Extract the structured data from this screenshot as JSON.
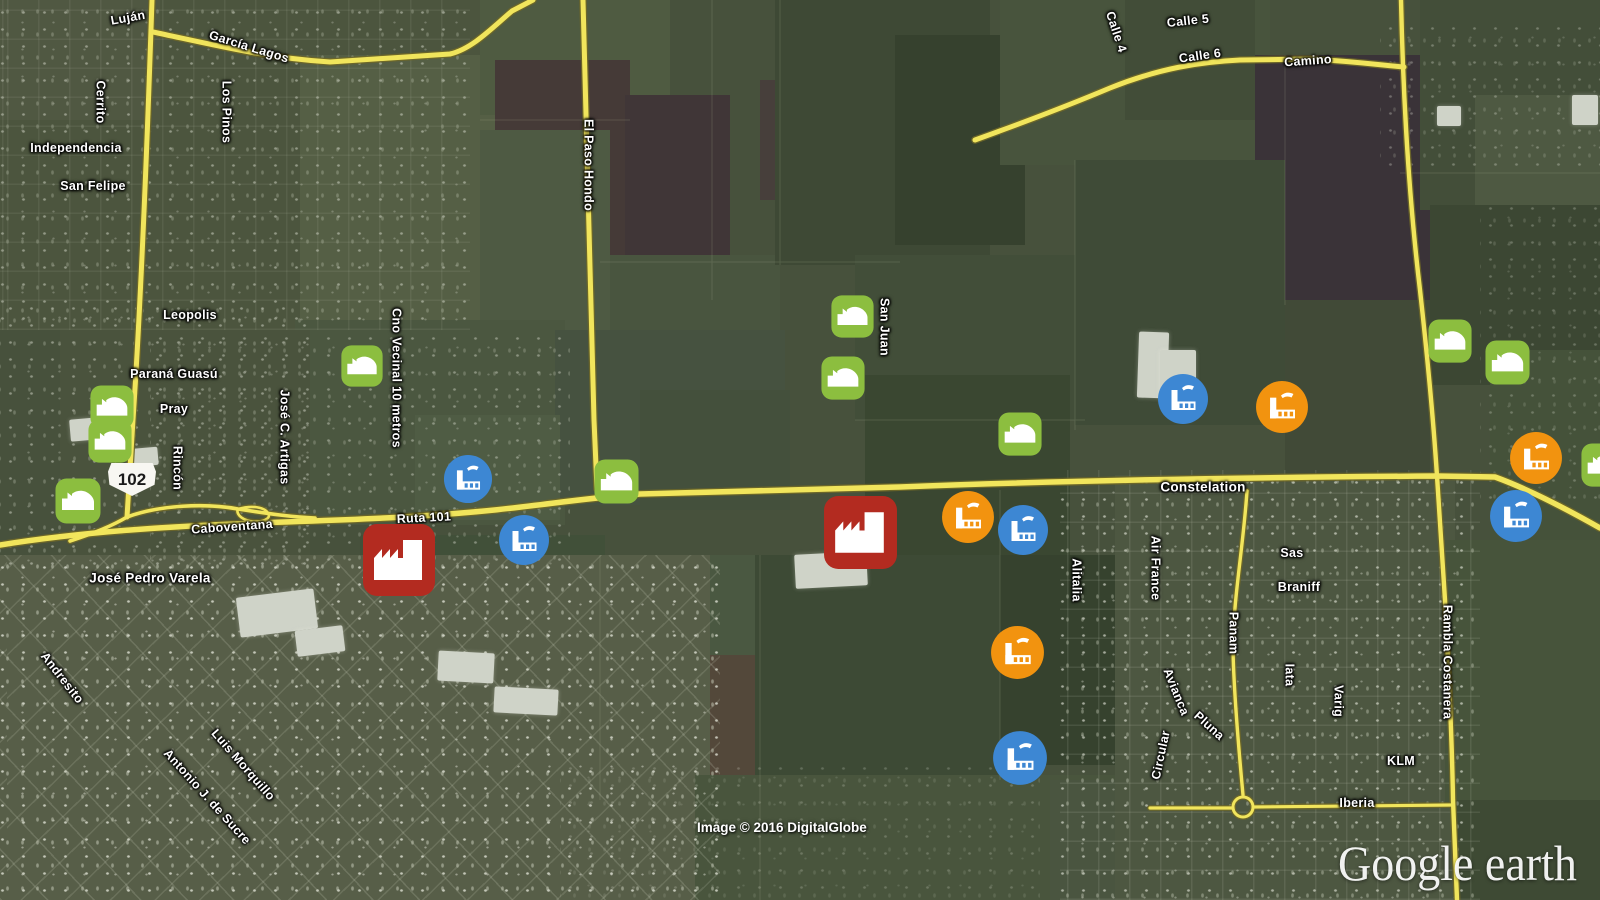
{
  "map": {
    "attribution": "Image © 2016 DigitalGlobe",
    "watermark": "Google earth",
    "route_shield": "102",
    "colors": {
      "road_fill": "#F1E55C",
      "road_casing": "#6E6728",
      "label_text": "#FFFFFF",
      "marker_green": "#8CBE3F",
      "marker_blue": "#3D87D3",
      "marker_orange": "#F2930F",
      "marker_red": "#B32B20",
      "shield_bg": "#F8F7F2",
      "shield_text": "#1A1A1A"
    },
    "labels": [
      {
        "text": "Luján",
        "x": 128,
        "y": 18,
        "rot": -10
      },
      {
        "text": "García Lagos",
        "x": 249,
        "y": 47,
        "rot": 17
      },
      {
        "text": "Los Pinos",
        "x": 226,
        "y": 112,
        "v": 1
      },
      {
        "text": "Cerrito",
        "x": 100,
        "y": 102,
        "v": 1
      },
      {
        "text": "Independencia",
        "x": 76,
        "y": 148
      },
      {
        "text": "San Felipe",
        "x": 93,
        "y": 186
      },
      {
        "text": "Leopolis",
        "x": 190,
        "y": 315
      },
      {
        "text": "Paraná Guasú",
        "x": 174,
        "y": 374
      },
      {
        "text": "Pray",
        "x": 174,
        "y": 409
      },
      {
        "text": "Rincón",
        "x": 177,
        "y": 468,
        "v": 1
      },
      {
        "text": "José C. Artigas",
        "x": 284,
        "y": 437,
        "v": 1
      },
      {
        "text": "Caboventana",
        "x": 232,
        "y": 527,
        "rot": -4
      },
      {
        "text": "Ruta 101",
        "x": 424,
        "y": 518,
        "rot": -3
      },
      {
        "text": "Cno Vecinal 10 metros",
        "x": 396,
        "y": 378,
        "v": 1
      },
      {
        "text": "El Paso Hondo",
        "x": 588,
        "y": 165,
        "v": 1
      },
      {
        "text": "San Juan",
        "x": 884,
        "y": 327,
        "v": 1
      },
      {
        "text": "Calle 4",
        "x": 1116,
        "y": 32,
        "rot": 72
      },
      {
        "text": "Calle 5",
        "x": 1188,
        "y": 21,
        "rot": -6
      },
      {
        "text": "Calle 6",
        "x": 1200,
        "y": 56,
        "rot": -8
      },
      {
        "text": "Camino",
        "x": 1308,
        "y": 61,
        "rot": -4
      },
      {
        "text": "Constelation",
        "x": 1203,
        "y": 487,
        "size": 13.5
      },
      {
        "text": "Alitalia",
        "x": 1076,
        "y": 580,
        "v": 1
      },
      {
        "text": "Air France",
        "x": 1155,
        "y": 568,
        "v": 1
      },
      {
        "text": "Sas",
        "x": 1292,
        "y": 553
      },
      {
        "text": "Braniff",
        "x": 1299,
        "y": 587
      },
      {
        "text": "Panam",
        "x": 1233,
        "y": 633,
        "v": 1
      },
      {
        "text": "Avianca",
        "x": 1176,
        "y": 692,
        "rot": 68
      },
      {
        "text": "Pluna",
        "x": 1209,
        "y": 726,
        "rot": 42
      },
      {
        "text": "Circular",
        "x": 1161,
        "y": 755,
        "rot": -78
      },
      {
        "text": "Iata",
        "x": 1289,
        "y": 675,
        "v": 1
      },
      {
        "text": "Varig",
        "x": 1338,
        "y": 701,
        "v": 1
      },
      {
        "text": "KLM",
        "x": 1401,
        "y": 761
      },
      {
        "text": "Iberia",
        "x": 1357,
        "y": 803
      },
      {
        "text": "Rambla Costanera",
        "x": 1447,
        "y": 662,
        "v": 1
      },
      {
        "text": "José Pedro Varela",
        "x": 150,
        "y": 578,
        "size": 13.5
      },
      {
        "text": "Andresito",
        "x": 62,
        "y": 678,
        "rot": 52
      },
      {
        "text": "Luis Morquillo",
        "x": 243,
        "y": 765,
        "rot": 49
      },
      {
        "text": "Antonio J. de Sucre",
        "x": 207,
        "y": 797,
        "rot": 48
      }
    ],
    "roads": [
      {
        "d": "M152,0 C148,120 141,300 133,420 L127,517",
        "w": 5
      },
      {
        "d": "M153,32 C210,44 265,58 330,62 L450,54 C472,49 492,28 512,11 L533,0",
        "w": 5
      },
      {
        "d": "M583,0 C588,150 592,300 594,420 L597,489",
        "w": 5
      },
      {
        "d": "M0,545 C150,521 300,524 420,516 C530,509 560,500 640,494 L900,487 C1100,479 1300,477 1437,476 L1495,477 C1528,489 1570,511 1600,528",
        "w": 5.5
      },
      {
        "d": "M70,541 C95,533 112,526 127,517 C160,505 205,503 238,509 C270,514 292,517 315,518",
        "w": 3.6
      },
      {
        "d": "M238,509 C252,505 264,507 268,513 C272,519 262,523 250,521 C240,519 236,513 238,509",
        "w": 2.6
      },
      {
        "d": "M975,140 C1000,131 1060,109 1110,88 C1160,68 1200,62 1240,60 L1312,59 C1360,62 1380,65 1404,67",
        "w": 5
      },
      {
        "d": "M1401,0 C1403,90 1408,190 1420,290 C1430,380 1434,430 1437,476 L1445,600 C1449,680 1452,740 1453,800 L1457,900",
        "w": 4.4
      },
      {
        "d": "M1247,491 C1243,550 1233,600 1233,650 C1234,700 1240,762 1243,795",
        "w": 3.4
      },
      {
        "d": "M1233,807 a10,10 0 1,0 20,0 a10,10 0 1,0 -20,0",
        "w": 3
      },
      {
        "d": "M1150,808 L1233,808 M1253,807 L1452,805",
        "w": 3.2
      }
    ],
    "markers": [
      {
        "t": "green",
        "x": 112,
        "y": 407,
        "s": 46
      },
      {
        "t": "green",
        "x": 110,
        "y": 441,
        "s": 46
      },
      {
        "t": "green",
        "x": 78,
        "y": 501,
        "s": 48
      },
      {
        "t": "green",
        "x": 362,
        "y": 366,
        "s": 44
      },
      {
        "t": "green",
        "x": 616,
        "y": 481,
        "s": 47
      },
      {
        "t": "green",
        "x": 852,
        "y": 316,
        "s": 45
      },
      {
        "t": "green",
        "x": 843,
        "y": 378,
        "s": 46
      },
      {
        "t": "green",
        "x": 1020,
        "y": 434,
        "s": 46
      },
      {
        "t": "green",
        "x": 1450,
        "y": 341,
        "s": 46
      },
      {
        "t": "green",
        "x": 1507,
        "y": 362,
        "s": 47
      },
      {
        "t": "green",
        "x": 1603,
        "y": 465,
        "s": 46
      },
      {
        "t": "blue",
        "x": 468,
        "y": 479,
        "s": 50
      },
      {
        "t": "blue",
        "x": 524,
        "y": 540,
        "s": 52
      },
      {
        "t": "blue",
        "x": 1023,
        "y": 530,
        "s": 52
      },
      {
        "t": "blue",
        "x": 1183,
        "y": 399,
        "s": 52
      },
      {
        "t": "blue",
        "x": 1516,
        "y": 516,
        "s": 54
      },
      {
        "t": "blue",
        "x": 1020,
        "y": 758,
        "s": 56
      },
      {
        "t": "orange",
        "x": 968,
        "y": 517,
        "s": 54
      },
      {
        "t": "orange",
        "x": 1282,
        "y": 407,
        "s": 54
      },
      {
        "t": "orange",
        "x": 1017,
        "y": 652,
        "s": 55
      },
      {
        "t": "orange",
        "x": 1536,
        "y": 458,
        "s": 54
      },
      {
        "t": "red",
        "x": 399,
        "y": 560,
        "s": 76
      },
      {
        "t": "red",
        "x": 860,
        "y": 532,
        "s": 77
      }
    ]
  }
}
